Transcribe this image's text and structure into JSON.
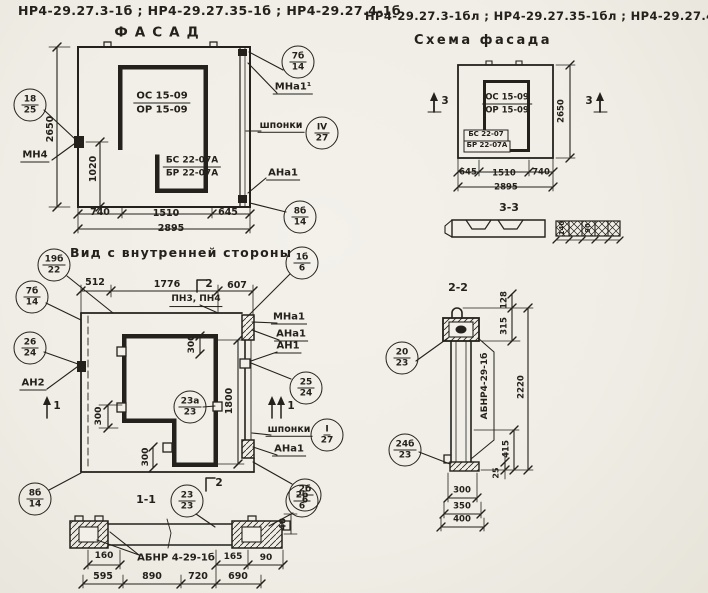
{
  "colors": {
    "paper": "#f1efe7",
    "ink": "#24211c"
  },
  "header": {
    "series_left": "НР4-29.27.3-1б ;  НР4-29.27.35-1б ;  НР4-29.27.4-1б",
    "series_right": "НР4-29.27.3-1бл ;  НР4-29.27.35-1бл ;  НР4-29.27.4-1бл"
  },
  "facade": {
    "title": "ФАСАД",
    "window_mark": {
      "top": "ОС 15-09",
      "bottom": "ОР 15-09"
    },
    "door_mark": {
      "top": "БС 22-07А",
      "bottom": "БР 22-07А"
    },
    "labels": {
      "mn4": "МН4",
      "mna1": "МНа1¹",
      "shponki": "шпонки",
      "ana1": "АНа1"
    },
    "callouts": {
      "c18_25": {
        "top": "18",
        "bot": "25"
      },
      "c7b_14": {
        "top": "7б",
        "bot": "14"
      },
      "c4_27": {
        "top": "IV",
        "bot": "27"
      },
      "c8b_14": {
        "top": "8б",
        "bot": "14"
      }
    },
    "dims": {
      "height": "2650",
      "h1020": "1020",
      "b1": "740",
      "b2": "1510",
      "b3": "645",
      "total": "2895"
    }
  },
  "inner": {
    "title": "Вид с внутренней стороны",
    "labels": {
      "pn": "ПН3, ПН4",
      "an2": "АН2",
      "mna1": "МНа1",
      "ana1": "АНа1",
      "an1": "АН1",
      "shponki": "шпонки",
      "ana1b": "АНа1"
    },
    "markers": {
      "m1": "1",
      "m1b": "1",
      "m2_top": "2",
      "m2_bottom": "2"
    },
    "callouts": {
      "c19b_22": {
        "top": "19б",
        "bot": "22"
      },
      "c7b_14": {
        "top": "7б",
        "bot": "14"
      },
      "c26_24": {
        "top": "26",
        "bot": "24"
      },
      "c1b_6": {
        "top": "1б",
        "bot": "6"
      },
      "c25_24": {
        "top": "25",
        "bot": "24"
      },
      "c1_27": {
        "top": "I",
        "bot": "27"
      },
      "c2b_6": {
        "top": "2б",
        "bot": "6"
      },
      "c23a_23": {
        "top": "23а",
        "bot": "23"
      },
      "c8b_14": {
        "top": "8б",
        "bot": "14"
      }
    },
    "dims": {
      "t1": "512",
      "t2": "1776",
      "t3": "607",
      "s300a": "300",
      "s300b": "300",
      "s300c": "300",
      "v1800": "1800"
    }
  },
  "sec11": {
    "title": "1-1",
    "label_abnr": "АБНР 4-29-1б",
    "marker2": "2",
    "callouts": {
      "c23_23": {
        "top": "23",
        "bot": "23"
      },
      "c2b_6": {
        "top": "2б",
        "bot": "6"
      }
    },
    "dims": {
      "d160": "160",
      "d165": "165",
      "d90": "90",
      "d40": "40",
      "b1": "595",
      "b2": "890",
      "b3": "720",
      "b4": "690"
    }
  },
  "scheme": {
    "title": "Схема фасада",
    "window_mark": {
      "top": "ОС 15-09",
      "bottom": "ОР 15-09"
    },
    "door_mark": {
      "top": "БС 22-07",
      "bottom": "БР 22-07А"
    },
    "marker3": "3",
    "dims": {
      "height": "2650",
      "b1": "645",
      "b2": "1510",
      "b3": "740",
      "total": "2895"
    }
  },
  "sec33": {
    "title": "3-3",
    "dims": {
      "d140": "140",
      "d90": "90"
    }
  },
  "sec22": {
    "title": "2-2",
    "label_abnr": "АБНР4-29-1б",
    "callouts": {
      "c20_23": {
        "top": "20",
        "bot": "23"
      },
      "c24b_23": {
        "top": "24б",
        "bot": "23"
      }
    },
    "dims": {
      "d128": "128",
      "d315": "315",
      "d2220": "2220",
      "d415": "415",
      "d25": "25",
      "b1": "300",
      "b2": "350",
      "b3": "400"
    }
  }
}
